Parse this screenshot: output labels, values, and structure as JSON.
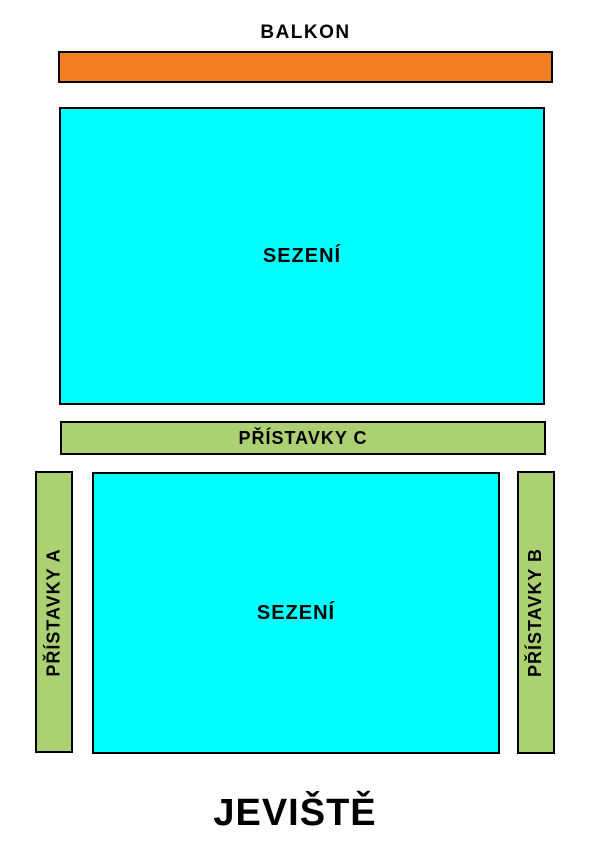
{
  "page": {
    "background": "#ffffff",
    "description_type": "theater-seating-plan"
  },
  "colors": {
    "balcony_fill": "#F47E22",
    "seating_fill": "#00FFFF",
    "annex_fill": "#ACD172",
    "outline": "#000000",
    "text": "#000000"
  },
  "labels": {
    "balcony": "BALKON",
    "seating_upper": "SEZENÍ",
    "annex_c": "PŘÍSTAVKY C",
    "annex_a": "PŘÍSTAVKY A",
    "seating_lower": "SEZENÍ",
    "annex_b": "PŘÍSTAVKY B",
    "stage": "JEVIŠTĚ"
  }
}
